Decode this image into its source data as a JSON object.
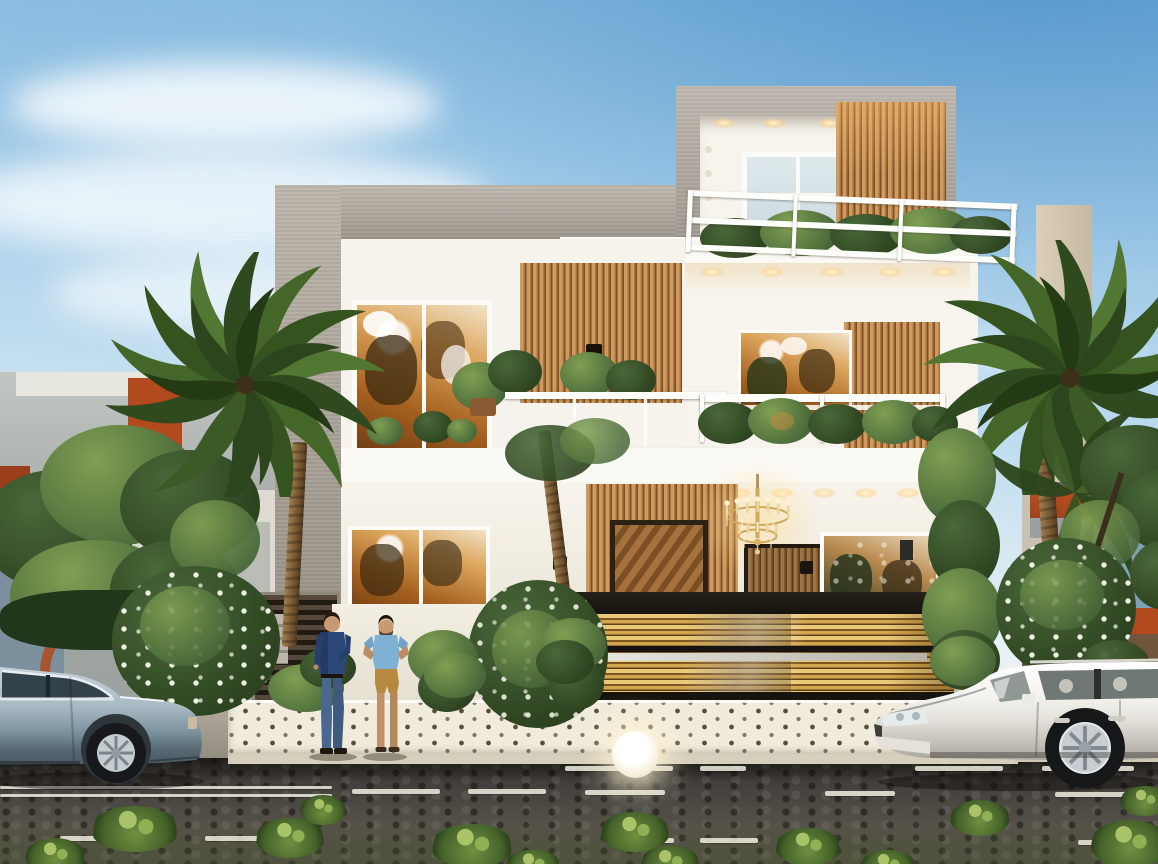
{
  "meta": {
    "type": "3d-architectural-rendering",
    "description": "Street-elevation 3D rendering of a modern three-storey villa with white walls, grey concrete frames and wooden slat accents; golden slatted compound gate, rooftop terrace railing, warm interior lighting with a crystal chandelier, palm trees, flowering shrubs, two luxury cars parked on a cobbled street and two men standing at the entrance."
  },
  "colors": {
    "sky_top": "#79b2db",
    "sky_horizon": "#f3f3ec",
    "concrete": "#b4aca1",
    "wall_white": "#f6f3ec",
    "slab_white": "#fbf9f3",
    "wood_light": "#cf9a60",
    "wood_mid": "#a9743e",
    "wood_dark": "#7c5026",
    "gate_gold": "#d2a64e",
    "gate_black": "#17130e",
    "interior_warm": "#dca55c",
    "interior_deep": "#6f3d14",
    "glass_blue": "#c3d5da",
    "railing_white": "#fdfdfa",
    "foliage_dark": "#2e4420",
    "foliage_mid": "#49683a",
    "foliage_light": "#7fa052",
    "trunk_brown": "#8a6a42",
    "flower_white": "#f3f4e8",
    "tile_white": "#f1ebdb",
    "tile_dot": "#3c3526",
    "curb": "#d6cfbc",
    "road_dark": "#45423e",
    "marking_white": "#eeece0",
    "car_silver": "#a9bac3",
    "car_white": "#f4f3ef",
    "skin": "#c79a72",
    "shirt_navy": "#2b4878",
    "jeans_blue": "#4a678f",
    "tee_blue": "#7fb1d4",
    "shorts_khaki": "#b5893f",
    "accent_orange": "#b24a1e",
    "bg_glass": "#7fa2b4",
    "lamp_glow": "#fff4d2",
    "chandelier_gold": "#cfa95e"
  },
  "scene": {
    "sky": {
      "description": "clear blue sky, deeper blue upper right, soft white clouds to the left"
    },
    "house": {
      "storeys": 3,
      "tower": {
        "description": "rooftop room with grey concrete frame, white sliding window and vertical wood slats"
      },
      "terrace": {
        "description": "white three-rail rooftop terrace railing with potted greenery"
      },
      "first_floor": {
        "description": "glass-fronted balcony, large warm-lit windows, vertical wood slat panels"
      },
      "ground_floor": {
        "description": "wood slat entrance wall, timber door, crystal chandelier visible inside, warm downlights"
      },
      "gate": {
        "description": "wide golden horizontal-slat sliding gate with black top and bottom rails and a silver stripe"
      },
      "planter": {
        "description": "white mosaic-tiled planter base with dark dot pattern and a glowing globe lamp"
      }
    },
    "vehicles": [
      {
        "type": "luxury sedan",
        "color_name": "silver blue",
        "position": "left, cropped by frame"
      },
      {
        "type": "SUV",
        "color_name": "white",
        "position": "right, cropped by frame"
      }
    ],
    "people": [
      {
        "description": "man in dark blue shirt and blue jeans"
      },
      {
        "description": "man in light blue t-shirt and khaki shorts, hands on hips"
      }
    ],
    "vegetation": {
      "left": [
        "dense green tree",
        "fan palm",
        "white-flowering frangipani shrubs"
      ],
      "right": [
        "tall fan palms",
        "dark leafy tree",
        "white-flowering shrub"
      ],
      "street": "grass tufts growing between cobbles"
    },
    "street": {
      "surface": "dark cobblestone",
      "markings": "white dashed lane lines in rows"
    },
    "background": {
      "left_building": "grey neighbouring house with orange accent panels",
      "right_building": "beige neighbouring house with orange bands and blue glazing"
    }
  }
}
